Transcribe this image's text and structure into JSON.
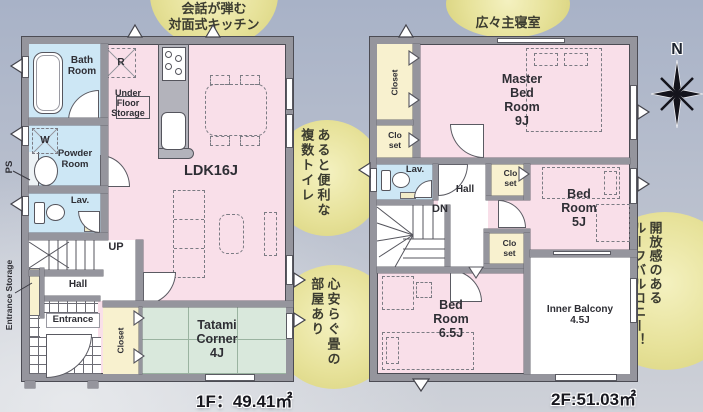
{
  "areas": {
    "floor1": "1F：49.41㎡",
    "floor2": "2F:51.03㎡"
  },
  "compass": {
    "north": "N"
  },
  "callouts": {
    "kitchen": "会話が弾む\n対面式キッチン",
    "master_bedroom": "広々主寝室",
    "toilets_col1": "あると便利な",
    "toilets_col2": "複数トイレ",
    "tatami_col1": "心安らぐ畳の",
    "tatami_col2": "部屋あり",
    "balcony_col1": "開放感のある",
    "balcony_col2": "ルーフバルコニー！"
  },
  "floor1": {
    "bath": "Bath\nRoom",
    "fridge": "R",
    "under_floor_storage": "Under\nFloor\nStorage",
    "washer": "W",
    "powder": "Powder\nRoom",
    "ps": "PS",
    "lav": "Lav.",
    "up": "UP",
    "hall": "Hall",
    "entrance_storage": "Entrance Storage",
    "entrance": "Entrance",
    "closet": "Closet",
    "ldk": "LDK16J",
    "tatami": "Tatami\nCorner\n4J"
  },
  "floor2": {
    "closet": "Closet",
    "closet_small": "Clo\nset",
    "master": "Master\nBed\nRoom\n9J",
    "lav": "Lav.",
    "hall": "Hall",
    "dn": "DN",
    "bed5": "Bed\nRoom\n5J",
    "bed65": "Bed\nRoom\n6.5J",
    "balcony": "Inner Balcony\n4.5J"
  }
}
